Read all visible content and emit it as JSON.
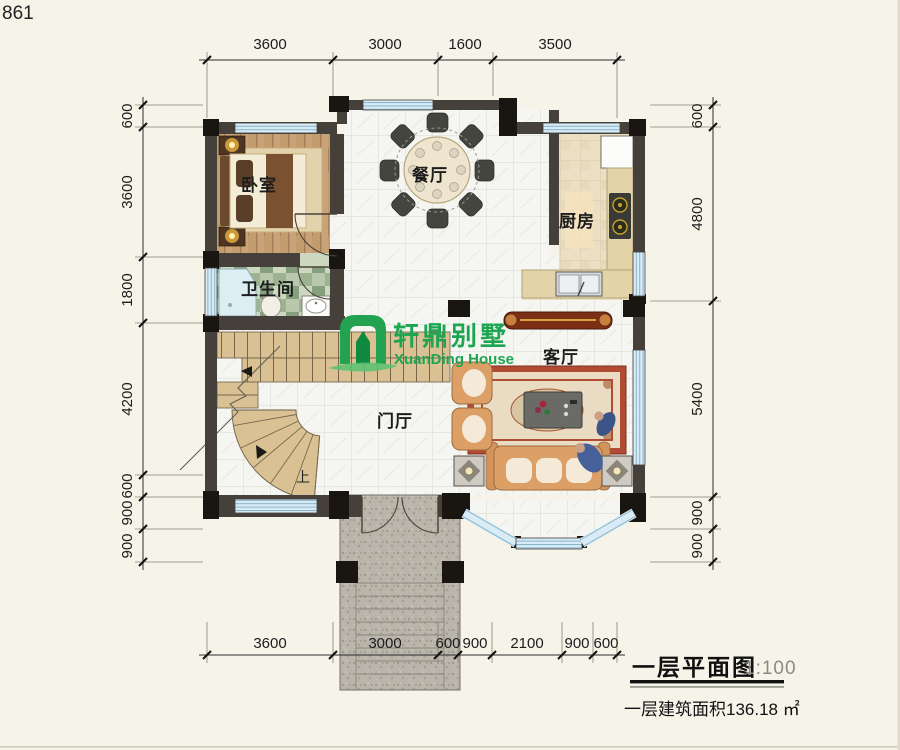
{
  "page_number": "861",
  "dimensions": {
    "top": [
      "3600",
      "3000",
      "1600",
      "3500"
    ],
    "left": [
      "600",
      "3600",
      "1800",
      "4200",
      "600",
      "900",
      "900"
    ],
    "right": [
      "600",
      "4800",
      "5400",
      "900",
      "900"
    ],
    "bottom": [
      "3600",
      "3000",
      "600",
      "900",
      "2100",
      "900",
      "600"
    ]
  },
  "rooms": {
    "bedroom": "卧室",
    "dining": "餐厅",
    "kitchen": "厨房",
    "bathroom": "卫生间",
    "living": "客厅",
    "foyer": "门厅",
    "stairs_up": "上"
  },
  "logo": {
    "name_cn": "轩鼎别墅",
    "name_en": "XuanDing House",
    "color": "#1ea552"
  },
  "title_block": {
    "title": "一层平面图",
    "scale": "1:100",
    "area_text": "一层建筑面积136.18 ㎡"
  },
  "colors": {
    "paper": "#f6f3e8",
    "wall": "#46403a",
    "column": "#191612",
    "window": "#d9ebf4",
    "window_stripe": "#85b4cd",
    "wood_floor": "#c9a377",
    "kitchen_tile": "#ebdfc4",
    "marble": "#f5f5f1",
    "bath_tile": "#a9bc9f",
    "stair": "#d9c193",
    "granite": "#b9b5ab",
    "sofa": "#dc9f66",
    "rug_border": "#b24b33",
    "logo_green": "#1ea552"
  }
}
